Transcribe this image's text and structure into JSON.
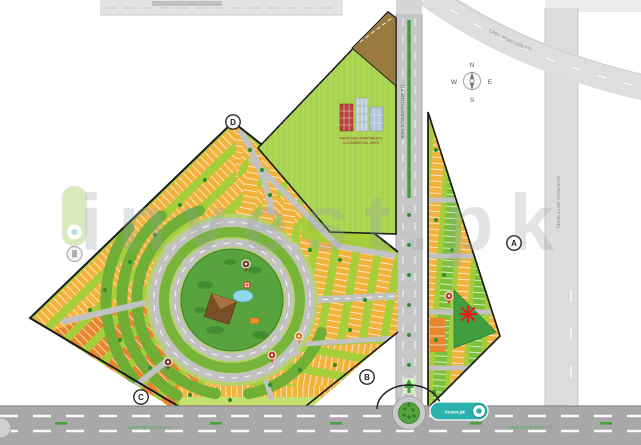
{
  "watermark": {
    "text": "invest.pk"
  },
  "badge": {
    "label": "invest.pk"
  },
  "compass": {
    "n": "N",
    "s": "S",
    "e": "E",
    "w": "W"
  },
  "roads": {
    "curved": "CPEC ROAD (150 FT)",
    "right_vertical": "MAIN ROAD (50 FT WIDE)",
    "boulevard": "MAIN BOULEVARD (100 FT)",
    "bottom_left": "MAIN ROAD (200 FT)",
    "bottom_right": "MAIN ROAD (200 FT)"
  },
  "markers": {
    "a": "A",
    "b": "B",
    "c": "C",
    "d": "D"
  },
  "labels": {
    "building_line1": "PROPOSED APARTMENTS",
    "building_line2": "& COMMERCIAL AREA"
  },
  "colors": {
    "parcel_green": "#a6ce39",
    "plot_yellow": "#f2b33d",
    "plot_orange": "#e8862c",
    "park_green": "#57a33e",
    "road_gray": "#c6c6c6",
    "accent_teal": "#2ab3ad"
  }
}
